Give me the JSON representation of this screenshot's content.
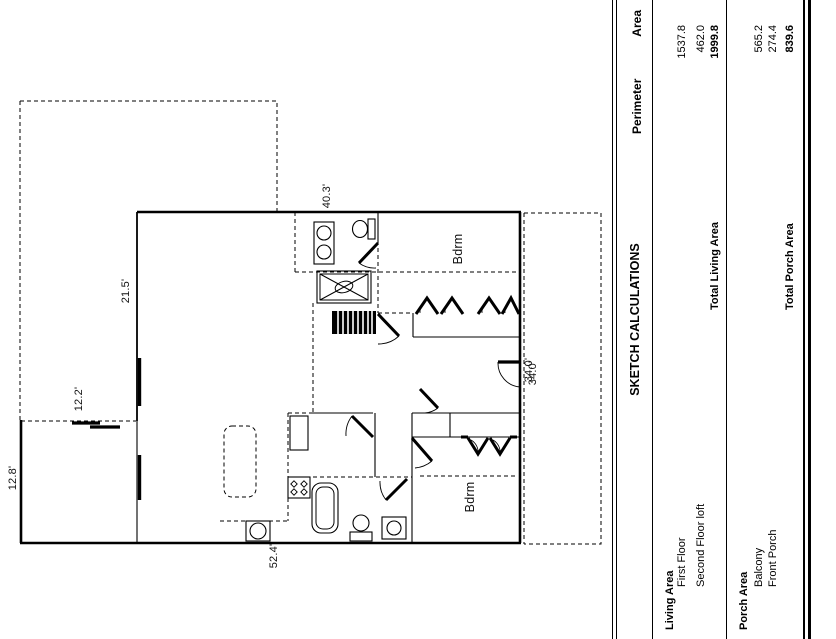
{
  "floor_plan": {
    "dimensions": {
      "top": "40.3'",
      "upper_left": "21.5'",
      "mid_left": "12.2'",
      "lower_left": "12.8'",
      "bottom": "52.4'",
      "right": "34.0'",
      "right_overlay": "34.0'"
    },
    "rooms": {
      "bedroom_upper": "Bdrm",
      "bedroom_lower": "Bdrm"
    }
  },
  "calculations": {
    "title": "SKETCH CALCULATIONS",
    "columns": {
      "perimeter": "Perimeter",
      "area": "Area"
    },
    "living": {
      "heading": "Living Area",
      "rows": [
        {
          "label": "First Floor",
          "area": "1537.8"
        },
        {
          "label": "Second Floor loft",
          "area": "462.0"
        }
      ],
      "total_label": "Total Living Area",
      "total_area": "1999.8"
    },
    "porch": {
      "heading": "Porch Area",
      "rows": [
        {
          "label": "Balcony",
          "area": "565.2"
        },
        {
          "label": "Front Porch",
          "area": "274.4"
        }
      ],
      "total_label": "Total Porch Area",
      "total_area": "839.6"
    }
  }
}
